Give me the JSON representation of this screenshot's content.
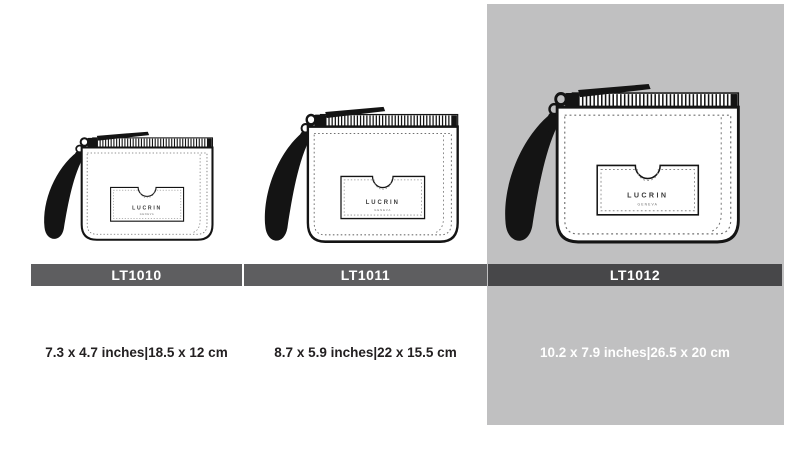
{
  "products": [
    {
      "code": "LT1010",
      "dimensions": "7.3 x 4.7 inches|18.5 x 12 cm",
      "highlighted": false
    },
    {
      "code": "LT1011",
      "dimensions": "8.7 x 5.9 inches|22 x 15.5 cm",
      "highlighted": false
    },
    {
      "code": "LT1012",
      "dimensions": "10.2 x 7.9 inches|26.5 x 20 cm",
      "highlighted": true
    }
  ],
  "brand": {
    "name": "LUCRIN",
    "sub": "GENEVA"
  },
  "icons": [
    "zipper-icon",
    "zipper-pull-icon",
    "wrist-strap-icon",
    "card-pocket-icon"
  ],
  "colors": {
    "bar": "#5e5e60",
    "bar_highlighted": "#474749",
    "highlight_panel": "#c0c0c1",
    "text_dark": "#232021",
    "text_light": "#ffffff",
    "outline": "#141414"
  }
}
